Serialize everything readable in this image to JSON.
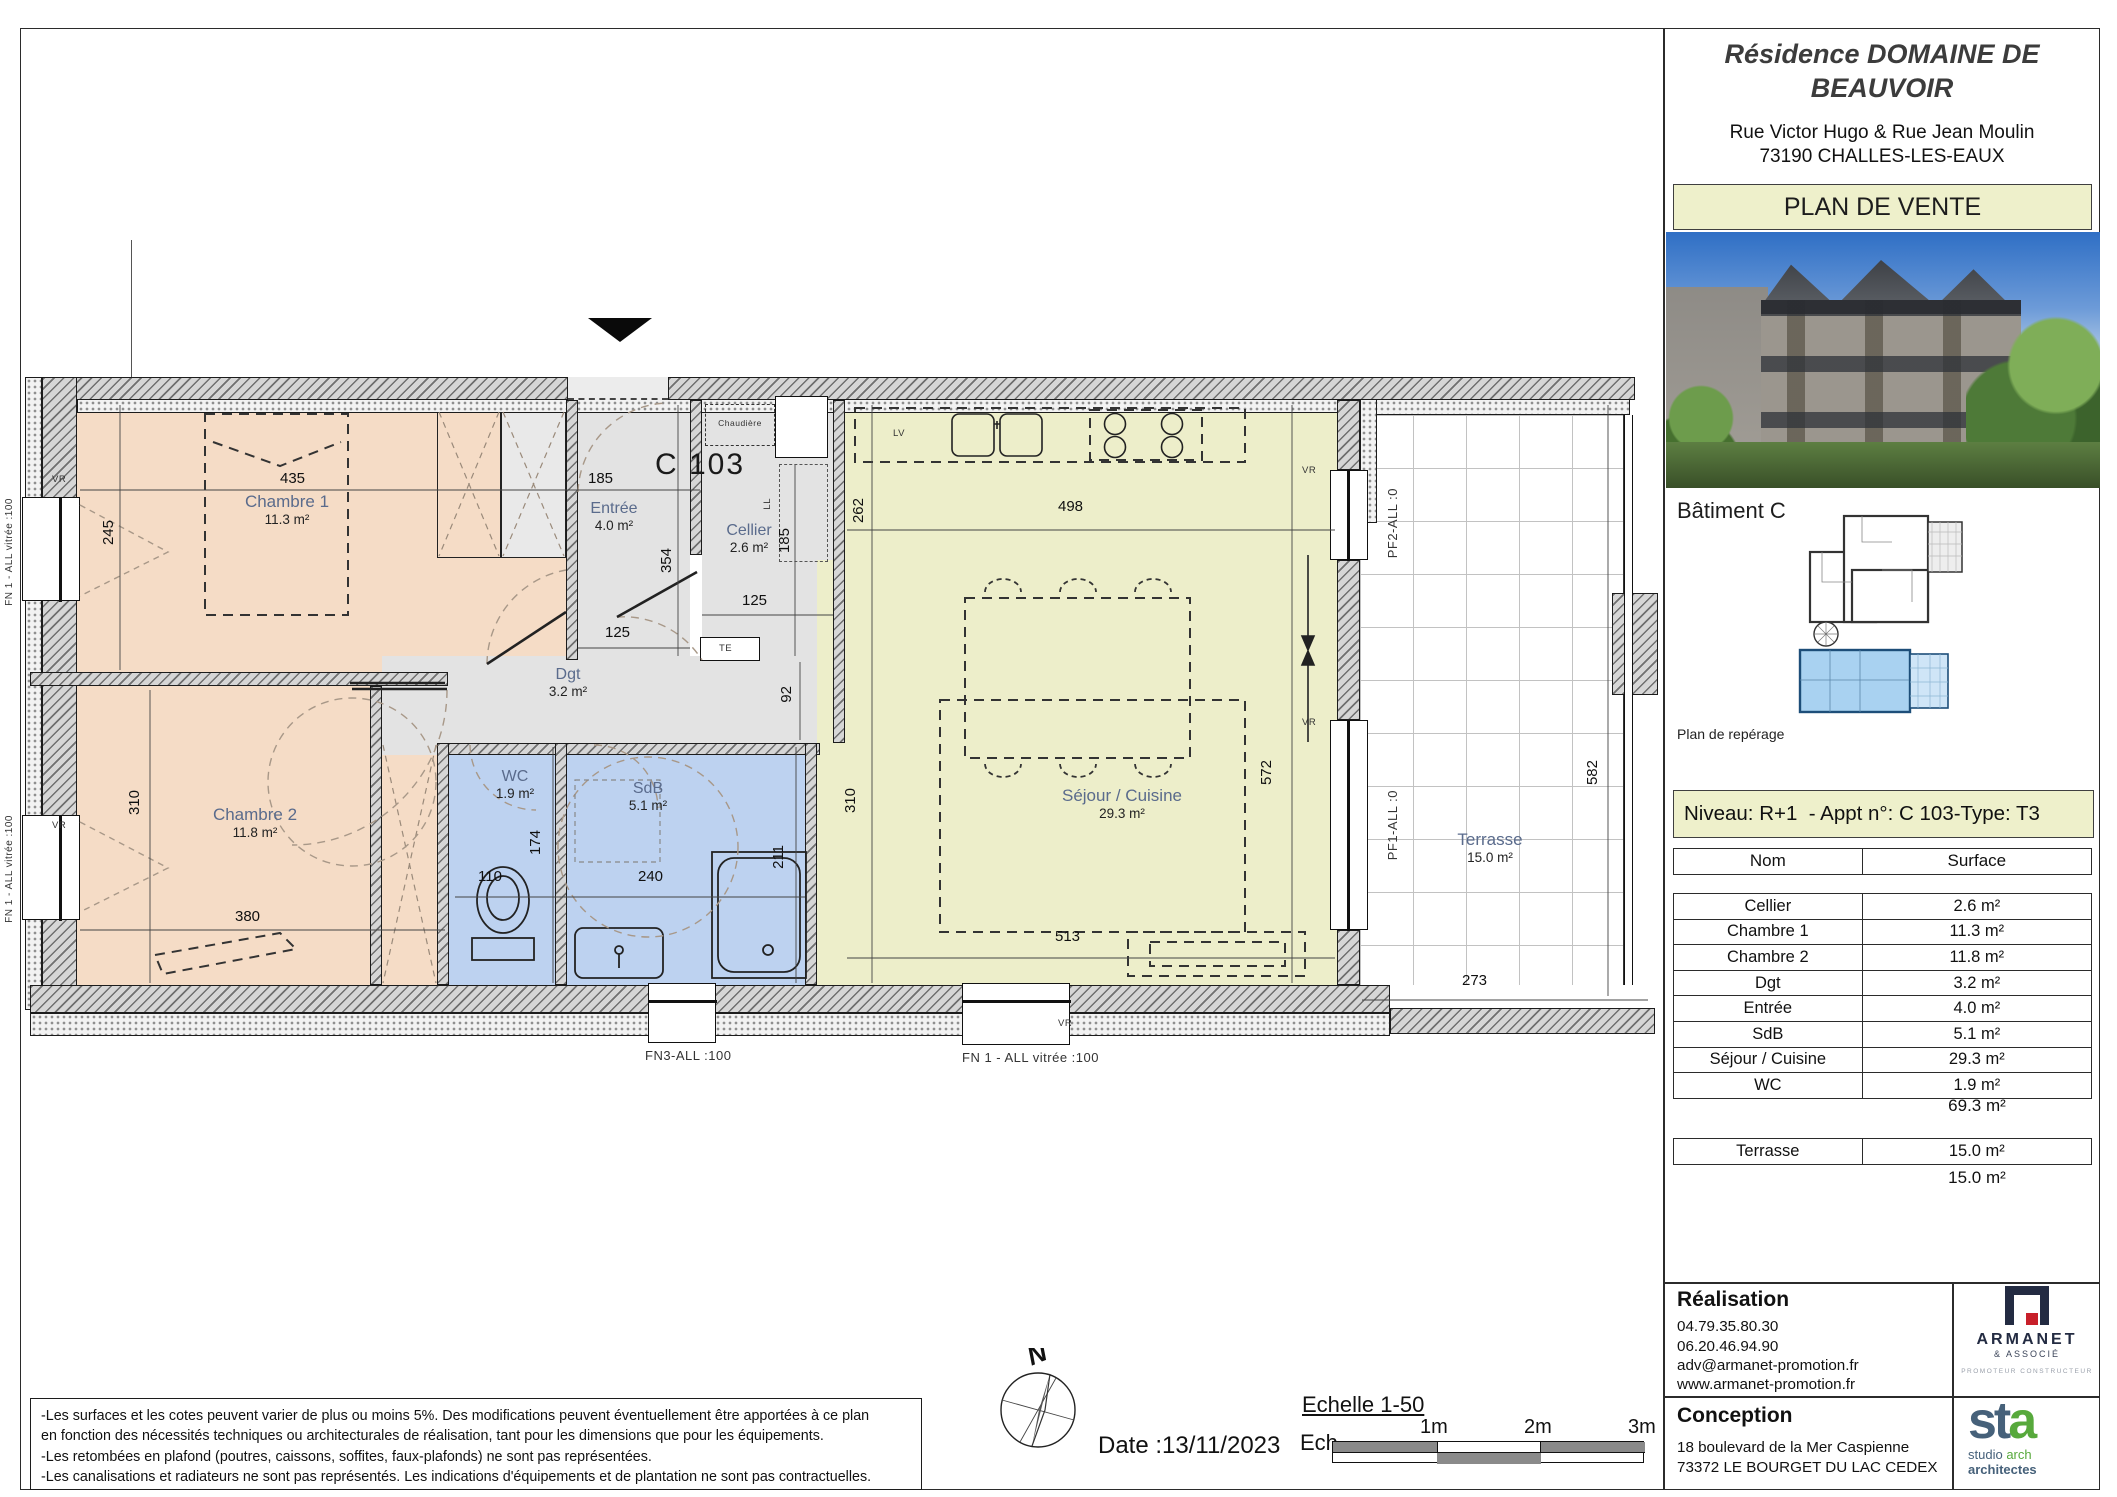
{
  "panel": {
    "title": "Résidence DOMAINE DE BEAUVOIR",
    "address_line1": "Rue Victor Hugo & Rue Jean Moulin",
    "address_line2": "73190 CHALLES-LES-EAUX",
    "banner": "PLAN DE VENTE",
    "batiment": "Bâtiment C",
    "reperage_caption": "Plan de repérage",
    "niveau": "Niveau: R+1  - Appt n°: C 103-Type: T3",
    "table": {
      "col_name": "Nom",
      "col_surface": "Surface",
      "rows": [
        {
          "name": "Cellier",
          "surface": "2.6 m²"
        },
        {
          "name": "Chambre 1",
          "surface": "11.3 m²"
        },
        {
          "name": "Chambre 2",
          "surface": "11.8 m²"
        },
        {
          "name": "Dgt",
          "surface": "3.2 m²"
        },
        {
          "name": "Entrée",
          "surface": "4.0 m²"
        },
        {
          "name": "SdB",
          "surface": "5.1 m²"
        },
        {
          "name": "Séjour / Cuisine",
          "surface": "29.3 m²"
        },
        {
          "name": "WC",
          "surface": "1.9 m²"
        }
      ],
      "total": "69.3 m²",
      "terrasse_row": {
        "name": "Terrasse",
        "surface": "15.0 m²"
      },
      "terrasse_total": "15.0 m²"
    },
    "realisation": {
      "title": "Réalisation",
      "phone1": "04.79.35.80.30",
      "phone2": "06.20.46.94.90",
      "email": "adv@armanet-promotion.fr",
      "website": "www.armanet-promotion.fr"
    },
    "conception": {
      "title": "Conception",
      "address1": "18 boulevard de la Mer Caspienne",
      "address2": "73372 LE BOURGET DU LAC CEDEX"
    },
    "armanet": {
      "name": "ARMANET",
      "sub": "& ASSOCIÉ",
      "tagline": "PROMOTEUR CONSTRUCTEUR"
    },
    "sta": {
      "word_st": "st",
      "word_a": "a",
      "line1_a": "studio",
      "line1_b": "arch",
      "line2": "architectes"
    }
  },
  "plan": {
    "unit_label": "C 103",
    "rooms": {
      "chambre1": {
        "name": "Chambre 1",
        "area": "11.3 m²"
      },
      "chambre2": {
        "name": "Chambre 2",
        "area": "11.8 m²"
      },
      "entree": {
        "name": "Entrée",
        "area": "4.0 m²"
      },
      "cellier": {
        "name": "Cellier",
        "area": "2.6 m²"
      },
      "dgt": {
        "name": "Dgt",
        "area": "3.2 m²"
      },
      "wc": {
        "name": "WC",
        "area": "1.9 m²"
      },
      "sdb": {
        "name": "SdB",
        "area": "5.1 m²"
      },
      "sejour": {
        "name": "Séjour / Cuisine",
        "area": "29.3 m²"
      },
      "terrasse": {
        "name": "Terrasse",
        "area": "15.0 m²"
      }
    },
    "dims": {
      "v435": "435",
      "v245": "245",
      "v185e": "185",
      "v354": "354",
      "v185c": "185",
      "v125e": "125",
      "v125c": "125",
      "v262": "262",
      "v92": "92",
      "v498": "498",
      "v572": "572",
      "v310a": "310",
      "v380": "380",
      "v110": "110",
      "v240": "240",
      "v174": "174",
      "v211": "211",
      "v310b": "310",
      "v513": "513",
      "v273": "273",
      "v582": "582"
    },
    "ann": {
      "vr": "VR",
      "lv": "LV",
      "ll": "LL",
      "te": "TE",
      "chaudiere": "Chaudière",
      "pf2": "PF2-ALL :0",
      "pf1": "PF1-ALL :0",
      "fn3": "FN3-ALL :100",
      "fn1": "FN 1 - ALL vitrée :100",
      "fn1_left": "FN 1 - ALL vitrée :100"
    }
  },
  "footer": {
    "disclaimer": [
      "-Les surfaces et les cotes peuvent varier de plus ou moins 5%. Des modifications peuvent éventuellement être apportées à ce plan",
      "en fonction des nécessités techniques ou architecturales de réalisation, tant pour les dimensions que pour les équipements.",
      "-Les retombées en plafond (poutres, caissons, soffites, faux-plafonds) ne sont pas représentées.",
      "-Les canalisations et radiateurs ne sont pas représentés. Les indications d'équipements et de plantation ne sont pas contractuelles."
    ],
    "date": "Date :13/11/2023",
    "scale": {
      "title": "Echelle 1-50",
      "ech": "Ech.",
      "m1": "1m",
      "m2": "2m",
      "m3": "3m"
    },
    "compass_n": "N"
  }
}
